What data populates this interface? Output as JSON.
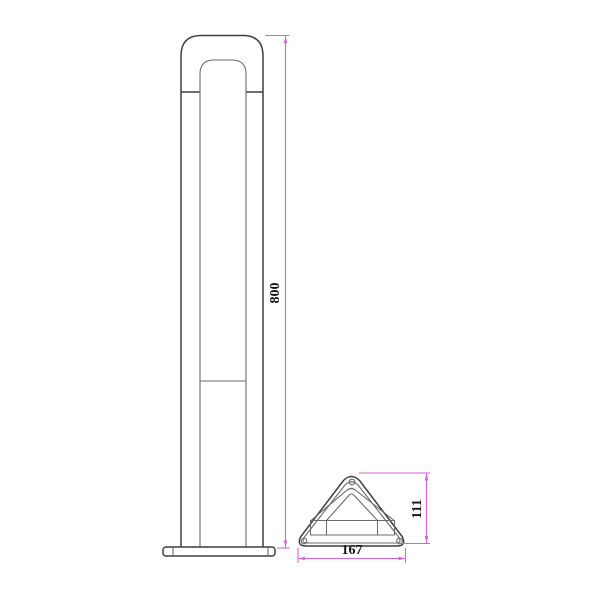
{
  "colors": {
    "bg": "#ffffff",
    "line": "#3f3f3f",
    "line2": "#6a6a6a",
    "dim": "#d863d8",
    "txt": "#151515"
  },
  "drawing": {
    "kind": "technical dimensioned drawing of a bollard light",
    "views": {
      "front_view": "front elevation of bollard lamp with inner diffuser panel and base plate",
      "top_view": "triangular base cross-section with three screw holes and lamp bracket"
    },
    "dimensions": {
      "height": {
        "value": "800",
        "orientation": "vertical",
        "applies_to": "overall bollard height"
      },
      "base_width": {
        "value": "167",
        "orientation": "horizontal",
        "applies_to": "base overall width"
      },
      "base_depth": {
        "value": "111",
        "orientation": "vertical",
        "applies_to": "base overall depth"
      }
    }
  }
}
